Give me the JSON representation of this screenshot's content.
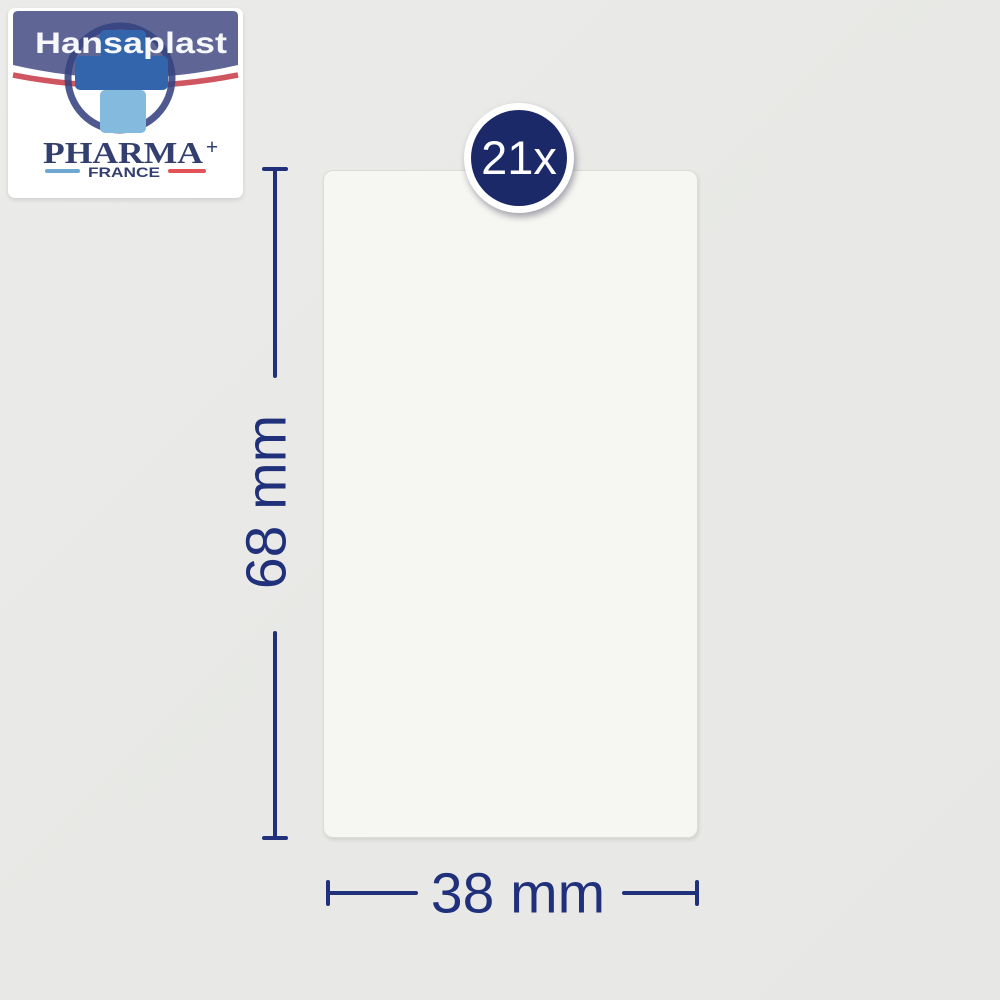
{
  "image": {
    "background_color": "#e9e9e7"
  },
  "logo": {
    "brand": "Hansaplast",
    "pharma": "PHARMA",
    "pharma_plus": "+",
    "country": "FRANCE",
    "colors": {
      "banner_blue": "#5f6695",
      "brand_text": "#f6f7fa",
      "cross_dark_blue": "#3265ac",
      "cross_light_blue": "#85badf",
      "ring_navy": "#36437f",
      "swoosh_red": "#cf5660",
      "pharma_navy": "#333f6e",
      "underline_blue": "#6fa8cf",
      "underline_red": "#e25257"
    }
  },
  "badge": {
    "label": "21x",
    "background": "#1c2968",
    "text_color": "#ffffff"
  },
  "plaster": {
    "fill": "#f6f6f2"
  },
  "dimensions": {
    "height_label": "68 mm",
    "width_label": "38 mm",
    "color": "#20307a"
  }
}
